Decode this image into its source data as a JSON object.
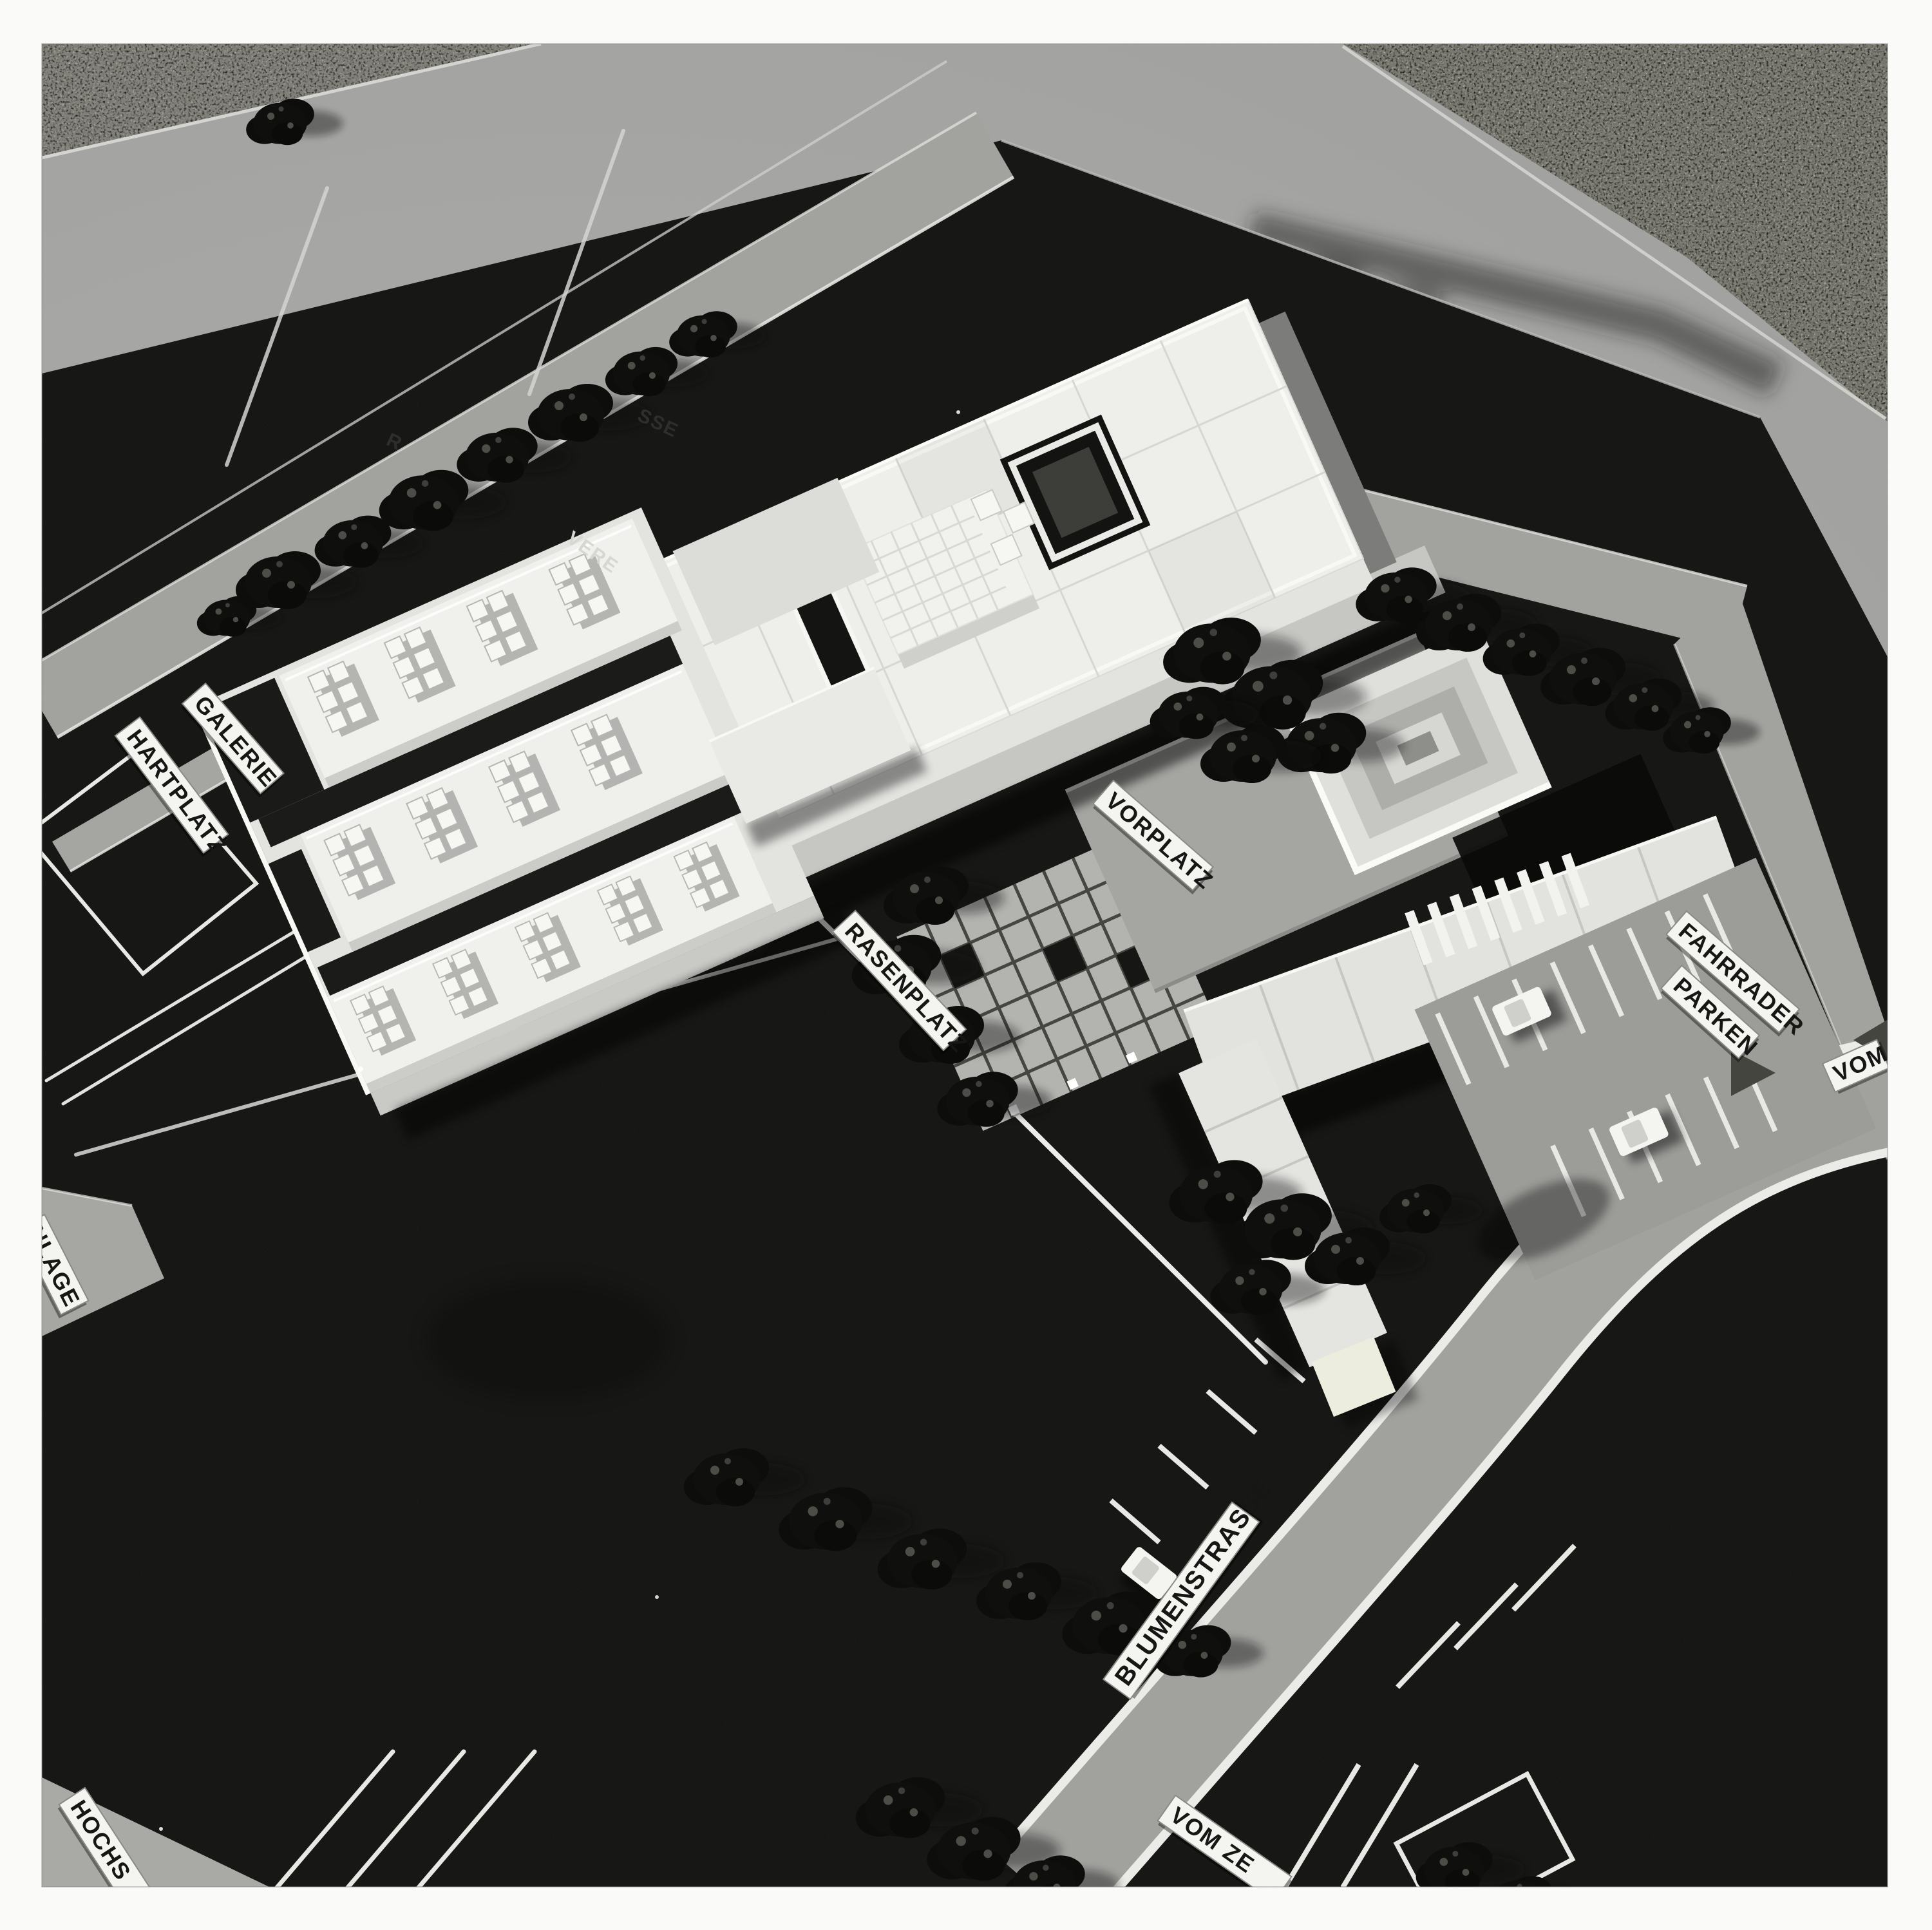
{
  "photo": {
    "description": "Black-and-white overhead photograph of an architectural scale model (school complex) standing on a light table: dark site board, light model streets, white flat-roofed buildings, dark model trees, sports fields and small white name plates with black lettering.",
    "labels": {
      "galerie": "GALERIE",
      "hartplatz": "HARTPLATZ",
      "rasenplatz": "RASENPLATZ",
      "vorplatz": "VORPLATZ",
      "fahrraeder": "FAHRRADER",
      "parken": "PARKEN",
      "blumenstrasse": "BLUMENSTRASSE",
      "vom": "VOM",
      "vom_zentrum_partial": "VOM ZE",
      "hochsprung_partial": "HOCHS",
      "anlage_partial": "NLAGE"
    },
    "street_name_fragments": [
      "R",
      "SSE",
      "VERE"
    ],
    "palette": {
      "paper_border": "#fafaf8",
      "table": "#a9a9a7",
      "gravel": "#807f78",
      "board": "#171715",
      "street": "#a2a29f",
      "building_top": "#efefec",
      "building_shade": "#8f8f8d",
      "tree": "#0e0e0c",
      "plate_bg": "#f4f4f1",
      "plate_text": "#161614"
    }
  }
}
